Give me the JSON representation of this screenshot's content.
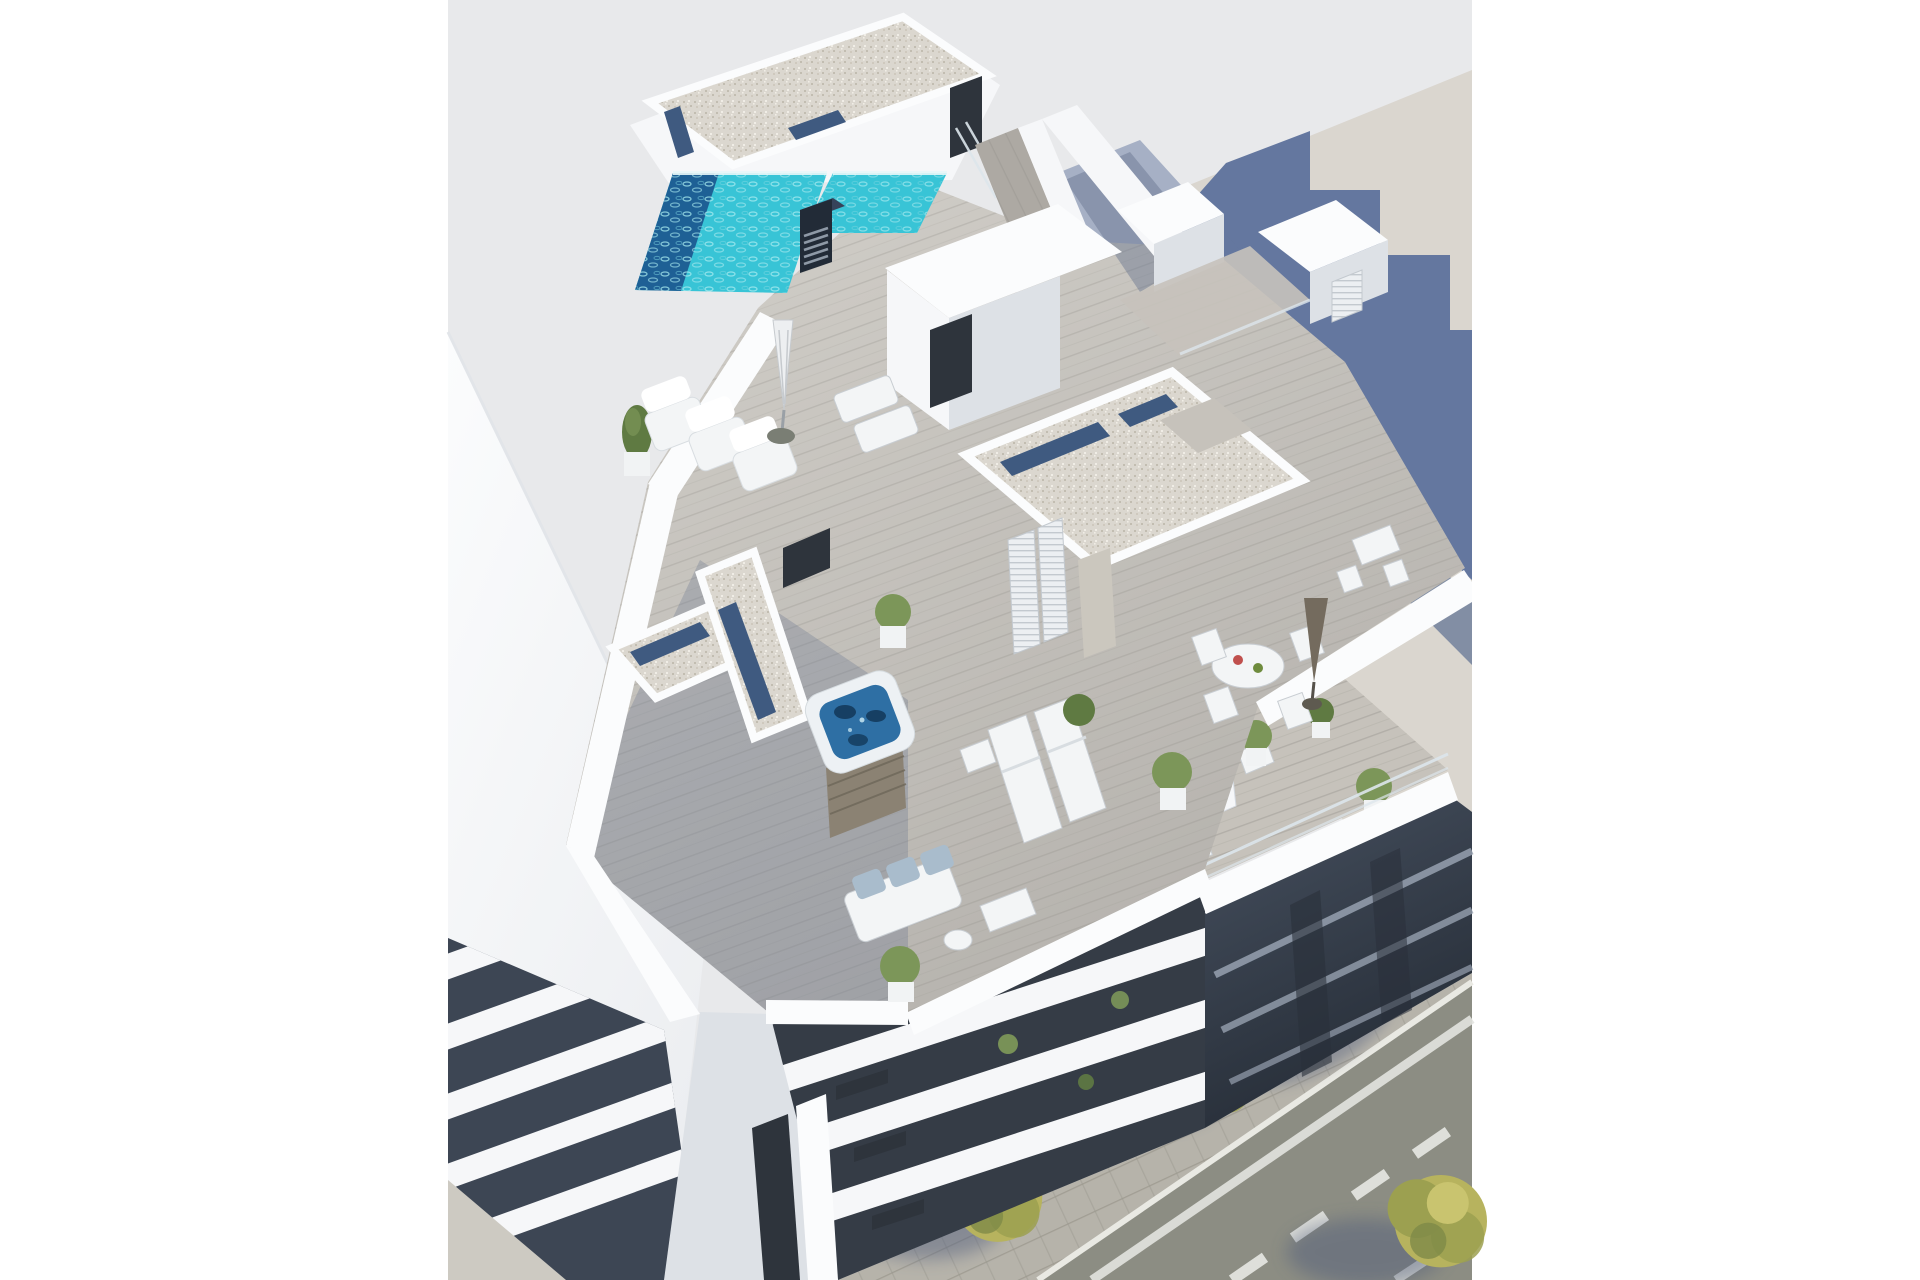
{
  "image": {
    "kind": "3d-architectural-render",
    "description": "Aerial 3D visualization of a modern white apartment building: rooftop terraces with swimming pool, jacuzzi, sun loungers and dining sets; lower balconies with sofas and plants; neighbouring buildings and a street with trees at the lower right."
  },
  "palette": {
    "margin_white": "#ffffff",
    "backdrop_gray": "#e8e9eb",
    "neighbor_wall_beige": "#dad6cf",
    "shadow_blue": "#64779f",
    "shadow_blue_deep": "#53678e",
    "building_white": "#f6f7f9",
    "building_lit": "#fbfcfd",
    "building_shade": "#dde1e6",
    "building_deep_shade": "#c6ccd4",
    "gravel_roof": "#dbd7cf",
    "gravel_dot_dark": "#c2bdb1",
    "gravel_dot_light": "#f0ede6",
    "skylight_blue": "#3f5a80",
    "pool_teal": "#38c4d6",
    "pool_deep": "#1e6095",
    "pool_ripple": "#a8eaef",
    "pool_rim": "#e8f8f9",
    "jacuzzi_water": "#2e6fa4",
    "jacuzzi_deep": "#163f63",
    "jacuzzi_shell": "#edf1f4",
    "jacuzzi_base": "#8b8273",
    "deck_light": "#c6c2bb",
    "deck_mid": "#ada9a3",
    "deck_plank_line": "#8f8c86",
    "deck_shadow": "#66748f",
    "facade_recess": "#353c46",
    "window_dark": "#2e343c",
    "curtain_gray": "#8e959d",
    "se_dark": "#3d4654",
    "se_deep": "#29303b",
    "slab_line_light": "#97a1b0",
    "street_asphalt": "#8c8d83",
    "sidewalk_gray": "#b6b3aa",
    "paver_line": "#9c998f",
    "curb_white": "#e9e9e3",
    "road_marking": "#e3e4df",
    "tree_yellow": "#b7b35e",
    "tree_olive": "#9ca050",
    "tree_deep": "#7e8a47",
    "trunk_brown": "#6b5f4a",
    "tree_shadow": "#4d5a7a",
    "plant_green": "#7c9659",
    "plant_deep": "#5f7a42",
    "pot_white": "#f1f3f4",
    "furniture_white": "#f3f5f6",
    "furniture_line": "#c8cdd2",
    "cushion_blue": "#a9bccc",
    "chimney_dark": "#222b37",
    "chimney_top": "#36435a",
    "louver_line": "#9aa5b3",
    "umbrella_white": "#edeff1",
    "umbrella_tan": "#746b5e",
    "glass_rail": "#dde6ec",
    "door_beige": "#cbc7be",
    "wall_beige_corner": "#cdcac2"
  },
  "scene": {
    "objects": [
      "rooftop swimming pool",
      "roof vent chimney",
      "gravel flat roofs with skylight strips",
      "jacuzzi hot tub on terrace",
      "rooftop lounge sofa with umbrella",
      "sun loungers",
      "round outdoor dining set with parasol",
      "high bar table with stools",
      "penthouse volumes with louvered shutters",
      "balcony with round table, chairs and potted plants",
      "terrace sofa with blue cushions",
      "white facade with dark recessed balconies",
      "dark shaded side facade",
      "left neighbouring building with balcony bands",
      "beige party wall with cast building shadow",
      "street with sidewalk, road markings and yellow-green trees"
    ]
  }
}
